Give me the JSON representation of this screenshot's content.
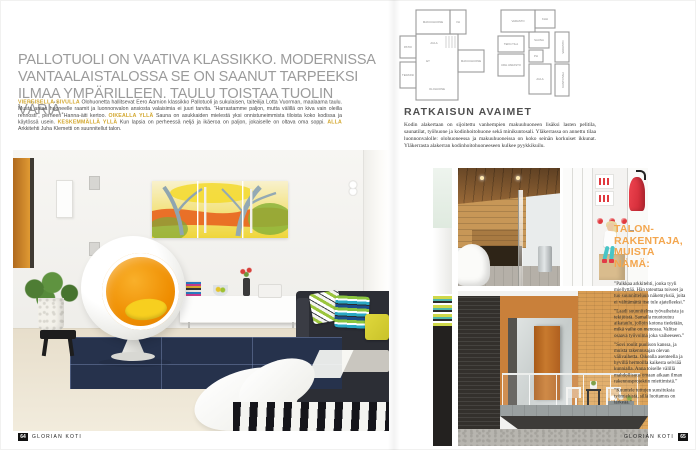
{
  "magazine": {
    "footer_left": {
      "page_number": "64",
      "brand": "GLORIAN KOTI"
    },
    "footer_right": {
      "page_number": "65",
      "brand": "GLORIAN KOTI"
    }
  },
  "headline": {
    "text": "PALLOTUOLI ON VAATIVA KLASSIKKO. MODERNISSA VANTAALAISTALOSSA SE ON SAANUT TARPEEKSI ILMAA YMPÄRILLEEN. TAULU TOISTAA TUOLIN VÄRIÄ."
  },
  "caption": {
    "segments": [
      {
        "label": "VIEREISELLÄ SIVULLA",
        "text": "Olohuonetta hallitsevat Eero Aarnion klassikko Pallotuoli ja sukulaisen, taiteilija Lotta Vuorman, maalaama taulu. Musta antaa huoneelle raamit ja luonnonvalon ansiosta valaisimia ei juuri tarvita. ”Harrastamme paljon, mutta välillä on kiva vain oleilla rennosti”, perheen Hanna-äiti kertoo."
      },
      {
        "label": "OIKEALLA YLLÄ",
        "text": "Sauna on asukkaiden mielestä yksi onnistuneimmista tiloista koko kodissa ja käytössä usein."
      },
      {
        "label": "KESKEMMÄLLÄ YLLÄ",
        "text": "Kun lapsia on perheessä neljä ja ikäeroa on paljon, jokaiselle on oltava oma soppi."
      },
      {
        "label": "ALLA",
        "text": "Arkkitehti Juha Klemetti on suunnitellut talon."
      }
    ]
  },
  "solution": {
    "title": "RATKAISUN AVAIMET",
    "body": "Kodin alakertaan on sijoitettu vanhempien makuuhuoneen lisäksi lasten pelitila, saunatilat, työhuone ja kodinhoitohuone sekä minikuntosali. Yläkerrassa on annettu tilaa luonnonvalolle: olohuoneessa ja makuuhuoneissa on koko seinän korkuiset ikkunat. Yläkerrasta alakerran kodinhoitohuoneeseen kulkee pyykkikuilu."
  },
  "floorplan": {
    "plan_upper": {
      "rooms": [
        "MAKUUHUONE",
        "VH",
        "AULA",
        "PATIO",
        "ET",
        "TERASSI",
        "MAKUUHUONE",
        "OLOHUONE"
      ]
    },
    "plan_lower": {
      "rooms": [
        "VARASTO",
        "KHH",
        "SAUNA",
        "PH",
        "TEKN.TILA",
        "URH.VARASTO",
        "AULA",
        "VARASTO",
        "KUNTOSALI"
      ]
    }
  },
  "builder_tips": {
    "title": "TALON-RAKENTAJA, MUISTA NÄMÄ:",
    "paragraphs": [
      "”Palkkaa arkkitehti, jonka tyyli miellyttää. Hän toteuttaa toiveet ja tuo suunnitteluun näkemyksiä, joita ei välttämättä itse tule ajatelleeksi.”",
      "”Laadi suunnitelma työvaiheista ja tekijöistä. Samalla muotoutuu aikataulu, jolloin kotona tiedetään, mikä vaihe on menossa. Valitse osaava työvoima joka vaiheeseen.”",
      "”Sovi roolit puolison kanssa, ja muista rakennusajan olevan välivaihetta. Oikealla asenteella ja hyvillä hermoilla kaikesta selviää kunnialla. Anna toiselle välillä mahdollisuus omaan aikaan ilman rakennusprojektin miettimistä.”",
      "”Kuuntele tuttujen suosituksia työmiehistä, sillä luottamus on tärkeää.”"
    ]
  },
  "colors": {
    "caption_label_yellow": "#d2a62c",
    "tips_heading_orange": "#f3a64e",
    "headline_gray": "#9b9b9b",
    "ballchair_orange": "#ef8d00"
  }
}
